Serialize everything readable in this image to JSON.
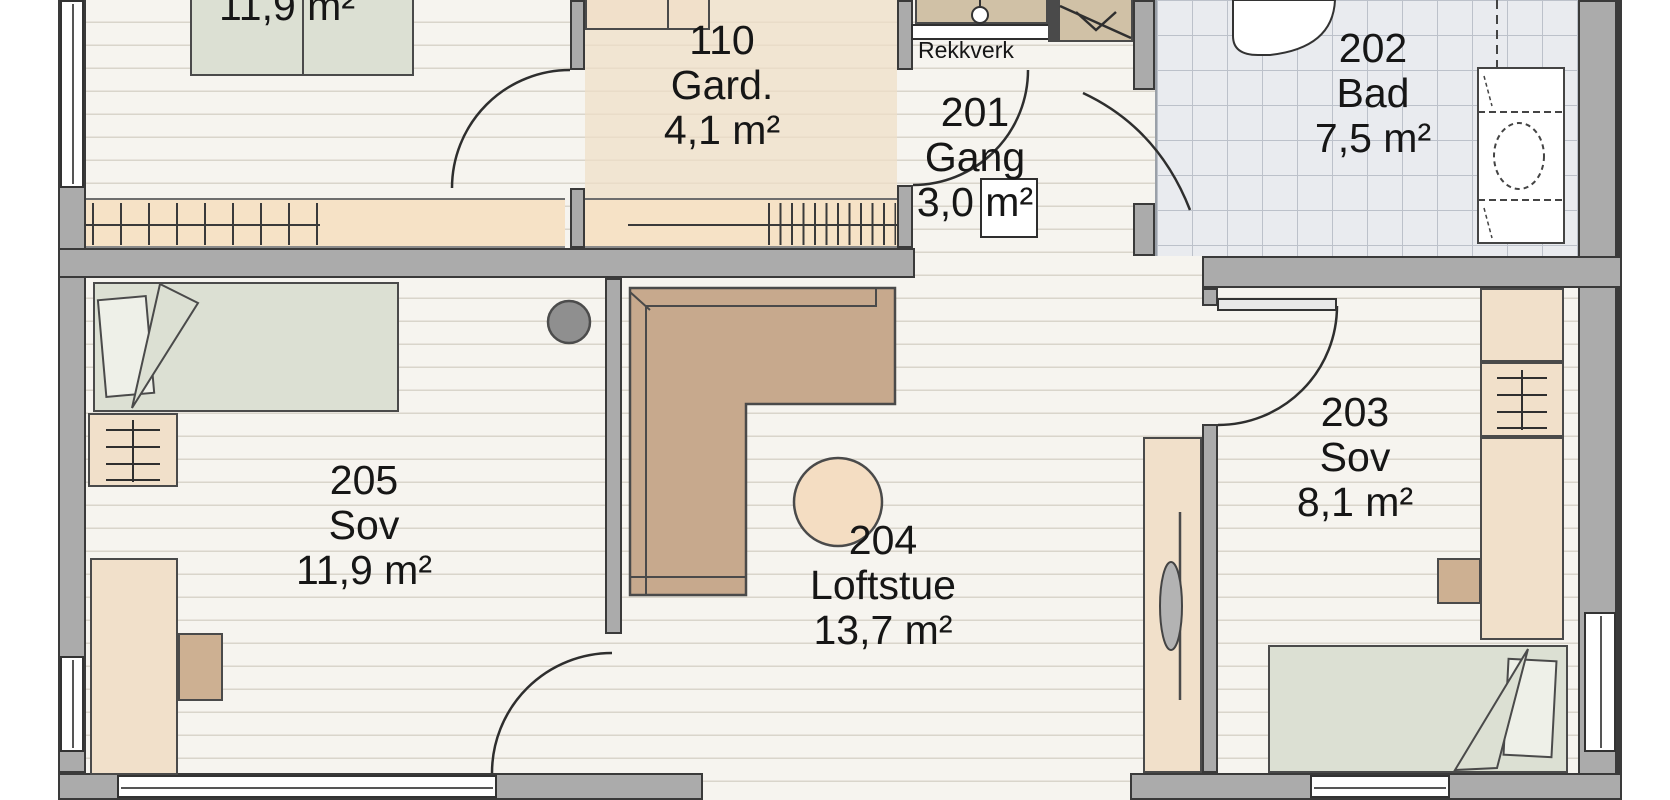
{
  "rooms": {
    "top_left_bedroom": {
      "area": "11,9 m²"
    },
    "gard": {
      "number": "110",
      "name": "Gard.",
      "area": "4,1 m²"
    },
    "gang": {
      "number": "201",
      "name": "Gang",
      "area": "3,0 m²"
    },
    "bad": {
      "number": "202",
      "name": "Bad",
      "area": "7,5 m²"
    },
    "sov_small": {
      "number": "203",
      "name": "Sov",
      "area": "8,1 m²"
    },
    "loftstue": {
      "number": "204",
      "name": "Loftstue",
      "area": "13,7 m²"
    },
    "sov_large": {
      "number": "205",
      "name": "Sov",
      "area": "11,9 m²"
    }
  },
  "annotations": {
    "railing_label": "Rekkverk"
  },
  "palette": {
    "wall_gray": "#ababab",
    "wall_outline": "#3a3a3a",
    "floor_wood": "#f6f4ef",
    "plank_line": "#d9d5cb",
    "bath_tile": "#e9ebef",
    "tile_line": "#bcc1ca",
    "highlight_beige": "#efdfc6",
    "furniture_tan": "#f1e0ca",
    "sofa_brown": "#c7a98d",
    "bed_sage": "#dce0d3",
    "stair_tan": "#d0c1a6"
  }
}
